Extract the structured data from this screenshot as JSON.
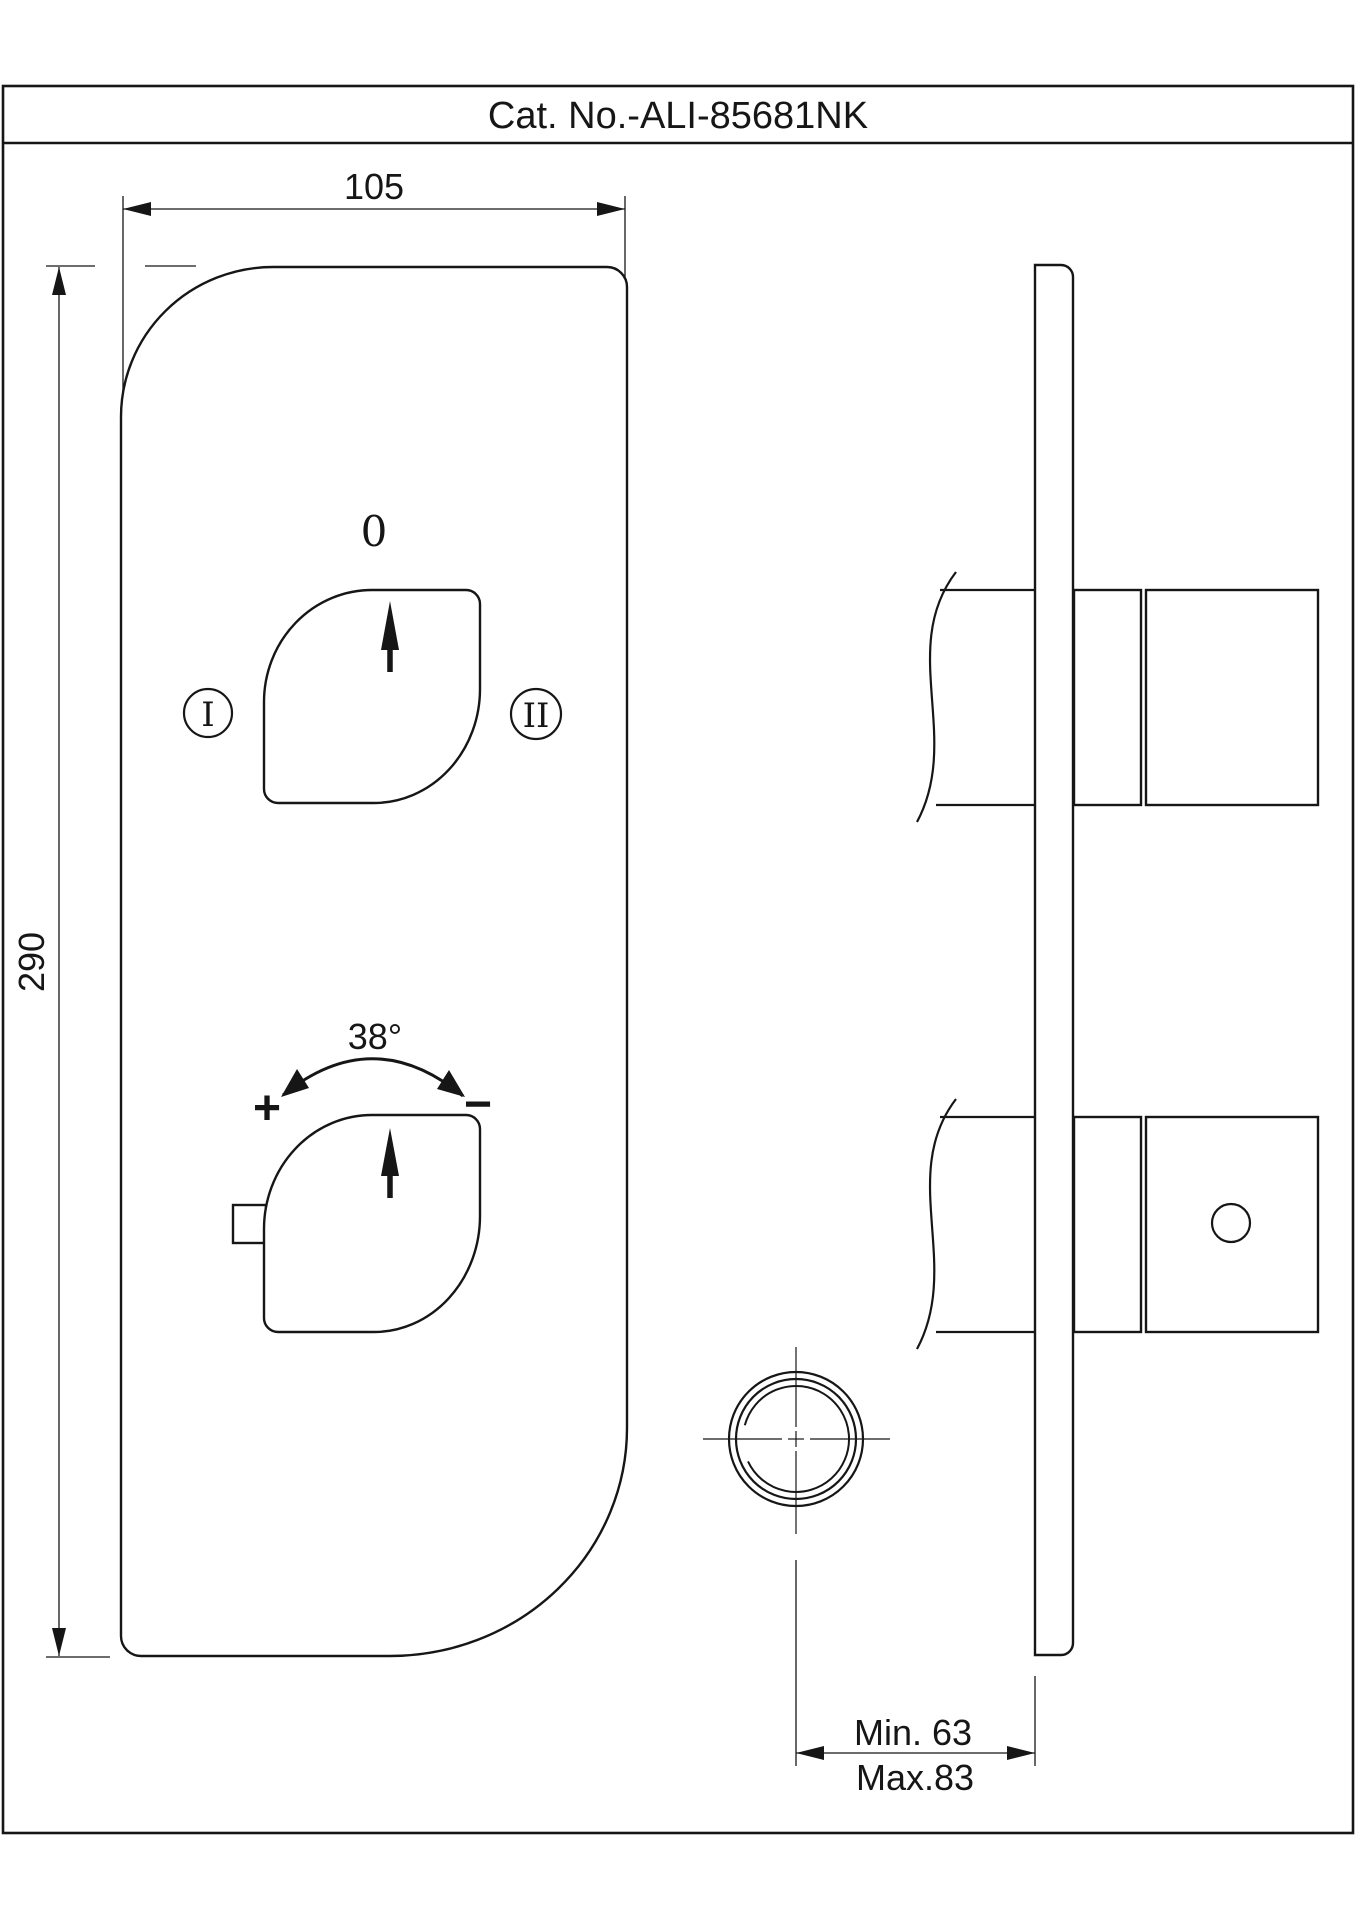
{
  "title_block": {
    "catalog_number": "Cat. No.-ALI-85681NK"
  },
  "front_view": {
    "width_dimension": "105",
    "height_dimension": "290",
    "diverter_knob": {
      "off_position": "0",
      "outlet_one": "I",
      "outlet_two": "II"
    },
    "temperature_knob": {
      "rotation_angle": "38°",
      "hotter": "+",
      "colder": "−"
    }
  },
  "side_view": {
    "min_depth": "Min. 63",
    "max_depth": "Max.83"
  },
  "colors": {
    "line": "#161616",
    "background": "#ffffff"
  }
}
